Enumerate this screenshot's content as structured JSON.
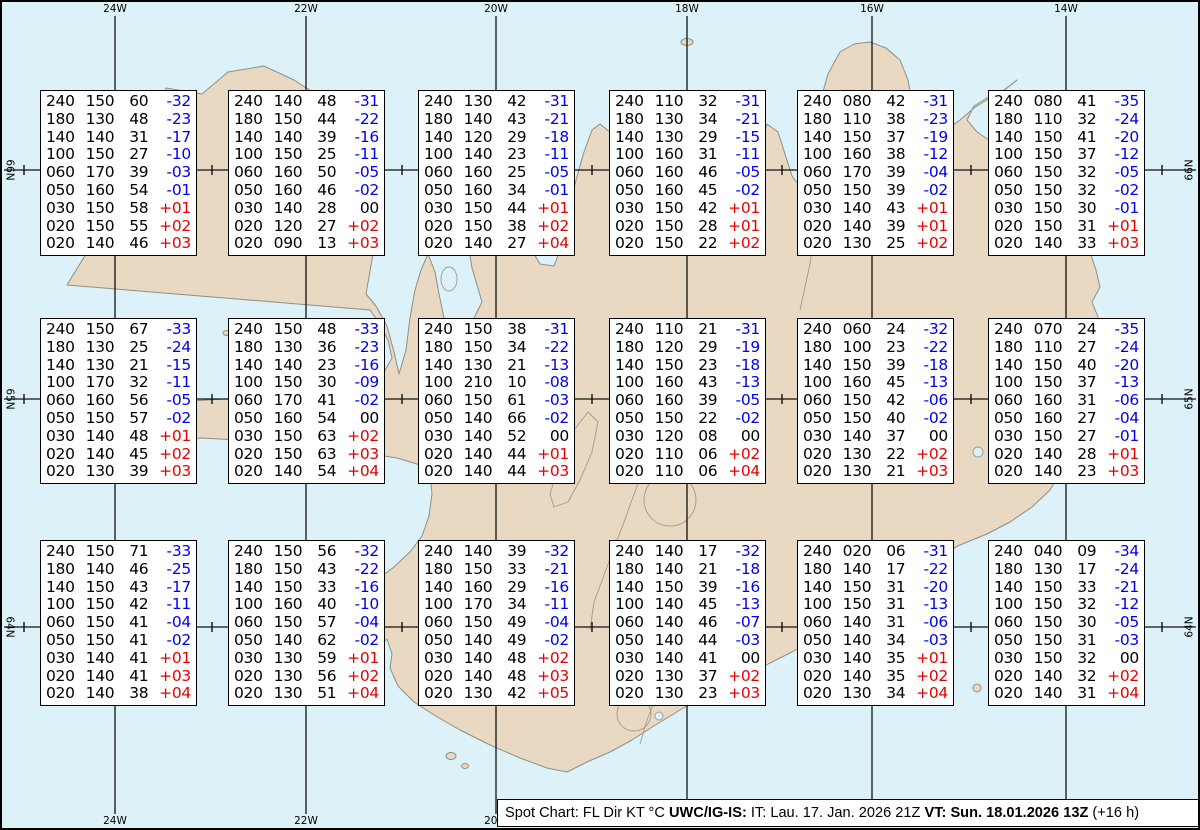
{
  "page": {
    "width": 1200,
    "height": 830
  },
  "colors": {
    "ocean": "#dcf2f8",
    "land": "#e9d8c2",
    "coast": "#8f8f85",
    "detail": "#9c9c94",
    "grid": "#111111",
    "temp_negative": "#0000f0",
    "temp_positive": "#e80000",
    "temp_zero": "#000000",
    "box_background": "#ffffff",
    "box_border": "#000000"
  },
  "grid": {
    "meridians": [
      {
        "label": "24W",
        "x": 113
      },
      {
        "label": "22W",
        "x": 304
      },
      {
        "label": "20W",
        "x": 494
      },
      {
        "label": "18W",
        "x": 685
      },
      {
        "label": "16W",
        "x": 870
      },
      {
        "label": "14W",
        "x": 1064
      }
    ],
    "parallels": [
      {
        "label": "66N",
        "y": 168
      },
      {
        "label": "65N",
        "y": 397
      },
      {
        "label": "64N",
        "y": 625
      }
    ],
    "tick_xs": [
      22,
      210,
      400,
      590,
      780,
      969,
      1160
    ]
  },
  "caption": {
    "segments": [
      {
        "text": "Spot Chart: FL Dir KT °C ",
        "bold": false
      },
      {
        "text": "UWC/IG-IS:",
        "bold": true
      },
      {
        "text": " IT: Lau. 17. Jan. 2026 21Z ",
        "bold": false
      },
      {
        "text": "VT: Sun. 18.01.2026 13Z",
        "bold": true
      },
      {
        "text": " (+16 h)",
        "bold": false
      }
    ]
  },
  "chart_data": {
    "type": "table",
    "title": "Spot Chart: FL Dir KT °C",
    "columns": [
      "FL",
      "Dir",
      "KT",
      "TempC"
    ],
    "stations": [
      {
        "row": 1,
        "col": 1,
        "x": 38,
        "y": 88,
        "rows": [
          [
            "240",
            "150",
            "60",
            "-32"
          ],
          [
            "180",
            "130",
            "48",
            "-23"
          ],
          [
            "140",
            "140",
            "31",
            "-17"
          ],
          [
            "100",
            "150",
            "27",
            "-10"
          ],
          [
            "060",
            "170",
            "39",
            "-03"
          ],
          [
            "050",
            "160",
            "54",
            "-01"
          ],
          [
            "030",
            "150",
            "58",
            "+01"
          ],
          [
            "020",
            "150",
            "55",
            "+02"
          ],
          [
            "020",
            "140",
            "46",
            "+03"
          ]
        ]
      },
      {
        "row": 1,
        "col": 2,
        "x": 226,
        "y": 88,
        "rows": [
          [
            "240",
            "140",
            "48",
            "-31"
          ],
          [
            "180",
            "150",
            "44",
            "-22"
          ],
          [
            "140",
            "140",
            "39",
            "-16"
          ],
          [
            "100",
            "150",
            "25",
            "-11"
          ],
          [
            "060",
            "160",
            "50",
            "-05"
          ],
          [
            "050",
            "160",
            "46",
            "-02"
          ],
          [
            "030",
            "140",
            "28",
            "00"
          ],
          [
            "020",
            "120",
            "27",
            "+02"
          ],
          [
            "020",
            "090",
            "13",
            "+03"
          ]
        ]
      },
      {
        "row": 1,
        "col": 3,
        "x": 416,
        "y": 88,
        "rows": [
          [
            "240",
            "130",
            "42",
            "-31"
          ],
          [
            "180",
            "140",
            "43",
            "-21"
          ],
          [
            "140",
            "120",
            "29",
            "-18"
          ],
          [
            "100",
            "140",
            "23",
            "-11"
          ],
          [
            "060",
            "160",
            "25",
            "-05"
          ],
          [
            "050",
            "160",
            "34",
            "-01"
          ],
          [
            "030",
            "150",
            "44",
            "+01"
          ],
          [
            "020",
            "150",
            "38",
            "+02"
          ],
          [
            "020",
            "140",
            "27",
            "+04"
          ]
        ]
      },
      {
        "row": 1,
        "col": 4,
        "x": 607,
        "y": 88,
        "rows": [
          [
            "240",
            "110",
            "32",
            "-31"
          ],
          [
            "180",
            "130",
            "34",
            "-21"
          ],
          [
            "140",
            "130",
            "29",
            "-15"
          ],
          [
            "100",
            "160",
            "31",
            "-11"
          ],
          [
            "060",
            "160",
            "46",
            "-05"
          ],
          [
            "050",
            "160",
            "45",
            "-02"
          ],
          [
            "030",
            "150",
            "42",
            "+01"
          ],
          [
            "020",
            "150",
            "28",
            "+01"
          ],
          [
            "020",
            "150",
            "22",
            "+02"
          ]
        ]
      },
      {
        "row": 1,
        "col": 5,
        "x": 795,
        "y": 88,
        "rows": [
          [
            "240",
            "080",
            "42",
            "-31"
          ],
          [
            "180",
            "110",
            "38",
            "-23"
          ],
          [
            "140",
            "150",
            "37",
            "-19"
          ],
          [
            "100",
            "160",
            "38",
            "-12"
          ],
          [
            "060",
            "170",
            "39",
            "-04"
          ],
          [
            "050",
            "150",
            "39",
            "-02"
          ],
          [
            "030",
            "140",
            "43",
            "+01"
          ],
          [
            "020",
            "140",
            "39",
            "+01"
          ],
          [
            "020",
            "130",
            "25",
            "+02"
          ]
        ]
      },
      {
        "row": 1,
        "col": 6,
        "x": 986,
        "y": 88,
        "rows": [
          [
            "240",
            "080",
            "41",
            "-35"
          ],
          [
            "180",
            "110",
            "32",
            "-24"
          ],
          [
            "140",
            "150",
            "41",
            "-20"
          ],
          [
            "100",
            "150",
            "37",
            "-12"
          ],
          [
            "060",
            "150",
            "32",
            "-05"
          ],
          [
            "050",
            "150",
            "32",
            "-02"
          ],
          [
            "030",
            "150",
            "30",
            "-01"
          ],
          [
            "020",
            "150",
            "31",
            "+01"
          ],
          [
            "020",
            "140",
            "33",
            "+03"
          ]
        ]
      },
      {
        "row": 2,
        "col": 1,
        "x": 38,
        "y": 316,
        "rows": [
          [
            "240",
            "150",
            "67",
            "-33"
          ],
          [
            "180",
            "130",
            "25",
            "-24"
          ],
          [
            "140",
            "130",
            "21",
            "-15"
          ],
          [
            "100",
            "170",
            "32",
            "-11"
          ],
          [
            "060",
            "160",
            "56",
            "-05"
          ],
          [
            "050",
            "150",
            "57",
            "-02"
          ],
          [
            "030",
            "140",
            "48",
            "+01"
          ],
          [
            "020",
            "140",
            "45",
            "+02"
          ],
          [
            "020",
            "130",
            "39",
            "+03"
          ]
        ]
      },
      {
        "row": 2,
        "col": 2,
        "x": 226,
        "y": 316,
        "rows": [
          [
            "240",
            "150",
            "48",
            "-33"
          ],
          [
            "180",
            "130",
            "36",
            "-23"
          ],
          [
            "140",
            "140",
            "23",
            "-16"
          ],
          [
            "100",
            "150",
            "30",
            "-09"
          ],
          [
            "060",
            "170",
            "41",
            "-02"
          ],
          [
            "050",
            "160",
            "54",
            "00"
          ],
          [
            "030",
            "150",
            "63",
            "+02"
          ],
          [
            "020",
            "150",
            "63",
            "+03"
          ],
          [
            "020",
            "140",
            "54",
            "+04"
          ]
        ]
      },
      {
        "row": 2,
        "col": 3,
        "x": 416,
        "y": 316,
        "rows": [
          [
            "240",
            "150",
            "38",
            "-31"
          ],
          [
            "180",
            "150",
            "34",
            "-22"
          ],
          [
            "140",
            "130",
            "21",
            "-13"
          ],
          [
            "100",
            "210",
            "10",
            "-08"
          ],
          [
            "060",
            "150",
            "61",
            "-03"
          ],
          [
            "050",
            "140",
            "66",
            "-02"
          ],
          [
            "030",
            "140",
            "52",
            "00"
          ],
          [
            "020",
            "140",
            "44",
            "+01"
          ],
          [
            "020",
            "140",
            "44",
            "+03"
          ]
        ]
      },
      {
        "row": 2,
        "col": 4,
        "x": 607,
        "y": 316,
        "rows": [
          [
            "240",
            "110",
            "21",
            "-31"
          ],
          [
            "180",
            "120",
            "29",
            "-19"
          ],
          [
            "140",
            "150",
            "23",
            "-18"
          ],
          [
            "100",
            "160",
            "43",
            "-13"
          ],
          [
            "060",
            "160",
            "39",
            "-05"
          ],
          [
            "050",
            "150",
            "22",
            "-02"
          ],
          [
            "030",
            "120",
            "08",
            "00"
          ],
          [
            "020",
            "110",
            "06",
            "+02"
          ],
          [
            "020",
            "110",
            "06",
            "+04"
          ]
        ]
      },
      {
        "row": 2,
        "col": 5,
        "x": 795,
        "y": 316,
        "rows": [
          [
            "240",
            "060",
            "24",
            "-32"
          ],
          [
            "180",
            "100",
            "23",
            "-22"
          ],
          [
            "140",
            "150",
            "39",
            "-18"
          ],
          [
            "100",
            "160",
            "45",
            "-13"
          ],
          [
            "060",
            "150",
            "42",
            "-06"
          ],
          [
            "050",
            "150",
            "40",
            "-02"
          ],
          [
            "030",
            "140",
            "37",
            "00"
          ],
          [
            "020",
            "130",
            "22",
            "+02"
          ],
          [
            "020",
            "130",
            "21",
            "+03"
          ]
        ]
      },
      {
        "row": 2,
        "col": 6,
        "x": 986,
        "y": 316,
        "rows": [
          [
            "240",
            "070",
            "24",
            "-35"
          ],
          [
            "180",
            "110",
            "27",
            "-24"
          ],
          [
            "140",
            "150",
            "40",
            "-20"
          ],
          [
            "100",
            "150",
            "37",
            "-13"
          ],
          [
            "060",
            "160",
            "31",
            "-06"
          ],
          [
            "050",
            "160",
            "27",
            "-04"
          ],
          [
            "030",
            "150",
            "27",
            "-01"
          ],
          [
            "020",
            "140",
            "28",
            "+01"
          ],
          [
            "020",
            "140",
            "23",
            "+03"
          ]
        ]
      },
      {
        "row": 3,
        "col": 1,
        "x": 38,
        "y": 538,
        "rows": [
          [
            "240",
            "150",
            "71",
            "-33"
          ],
          [
            "180",
            "140",
            "46",
            "-25"
          ],
          [
            "140",
            "150",
            "43",
            "-17"
          ],
          [
            "100",
            "150",
            "42",
            "-11"
          ],
          [
            "060",
            "150",
            "41",
            "-04"
          ],
          [
            "050",
            "150",
            "41",
            "-02"
          ],
          [
            "030",
            "140",
            "41",
            "+01"
          ],
          [
            "020",
            "140",
            "41",
            "+03"
          ],
          [
            "020",
            "140",
            "38",
            "+04"
          ]
        ]
      },
      {
        "row": 3,
        "col": 2,
        "x": 226,
        "y": 538,
        "rows": [
          [
            "240",
            "150",
            "56",
            "-32"
          ],
          [
            "180",
            "150",
            "43",
            "-22"
          ],
          [
            "140",
            "150",
            "33",
            "-16"
          ],
          [
            "100",
            "160",
            "40",
            "-10"
          ],
          [
            "060",
            "150",
            "57",
            "-04"
          ],
          [
            "050",
            "140",
            "62",
            "-02"
          ],
          [
            "030",
            "130",
            "59",
            "+01"
          ],
          [
            "020",
            "130",
            "56",
            "+02"
          ],
          [
            "020",
            "130",
            "51",
            "+04"
          ]
        ]
      },
      {
        "row": 3,
        "col": 3,
        "x": 416,
        "y": 538,
        "rows": [
          [
            "240",
            "140",
            "39",
            "-32"
          ],
          [
            "180",
            "150",
            "33",
            "-21"
          ],
          [
            "140",
            "160",
            "29",
            "-16"
          ],
          [
            "100",
            "170",
            "34",
            "-11"
          ],
          [
            "060",
            "150",
            "49",
            "-04"
          ],
          [
            "050",
            "140",
            "49",
            "-02"
          ],
          [
            "030",
            "140",
            "48",
            "+02"
          ],
          [
            "020",
            "140",
            "48",
            "+03"
          ],
          [
            "020",
            "130",
            "42",
            "+05"
          ]
        ]
      },
      {
        "row": 3,
        "col": 4,
        "x": 607,
        "y": 538,
        "rows": [
          [
            "240",
            "140",
            "17",
            "-32"
          ],
          [
            "180",
            "140",
            "21",
            "-18"
          ],
          [
            "140",
            "150",
            "39",
            "-16"
          ],
          [
            "100",
            "140",
            "45",
            "-13"
          ],
          [
            "060",
            "140",
            "46",
            "-07"
          ],
          [
            "050",
            "140",
            "44",
            "-03"
          ],
          [
            "030",
            "140",
            "41",
            "00"
          ],
          [
            "020",
            "130",
            "37",
            "+02"
          ],
          [
            "020",
            "130",
            "23",
            "+03"
          ]
        ]
      },
      {
        "row": 3,
        "col": 5,
        "x": 795,
        "y": 538,
        "rows": [
          [
            "240",
            "020",
            "06",
            "-31"
          ],
          [
            "180",
            "140",
            "17",
            "-22"
          ],
          [
            "140",
            "150",
            "31",
            "-20"
          ],
          [
            "100",
            "150",
            "31",
            "-13"
          ],
          [
            "060",
            "140",
            "31",
            "-06"
          ],
          [
            "050",
            "140",
            "34",
            "-03"
          ],
          [
            "030",
            "140",
            "35",
            "+01"
          ],
          [
            "020",
            "140",
            "35",
            "+02"
          ],
          [
            "020",
            "130",
            "34",
            "+04"
          ]
        ]
      },
      {
        "row": 3,
        "col": 6,
        "x": 986,
        "y": 538,
        "rows": [
          [
            "240",
            "040",
            "09",
            "-34"
          ],
          [
            "180",
            "130",
            "17",
            "-24"
          ],
          [
            "140",
            "150",
            "33",
            "-21"
          ],
          [
            "100",
            "150",
            "32",
            "-12"
          ],
          [
            "060",
            "150",
            "30",
            "-05"
          ],
          [
            "050",
            "150",
            "31",
            "-03"
          ],
          [
            "030",
            "150",
            "32",
            "00"
          ],
          [
            "020",
            "140",
            "32",
            "+02"
          ],
          [
            "020",
            "140",
            "31",
            "+04"
          ]
        ]
      }
    ]
  }
}
